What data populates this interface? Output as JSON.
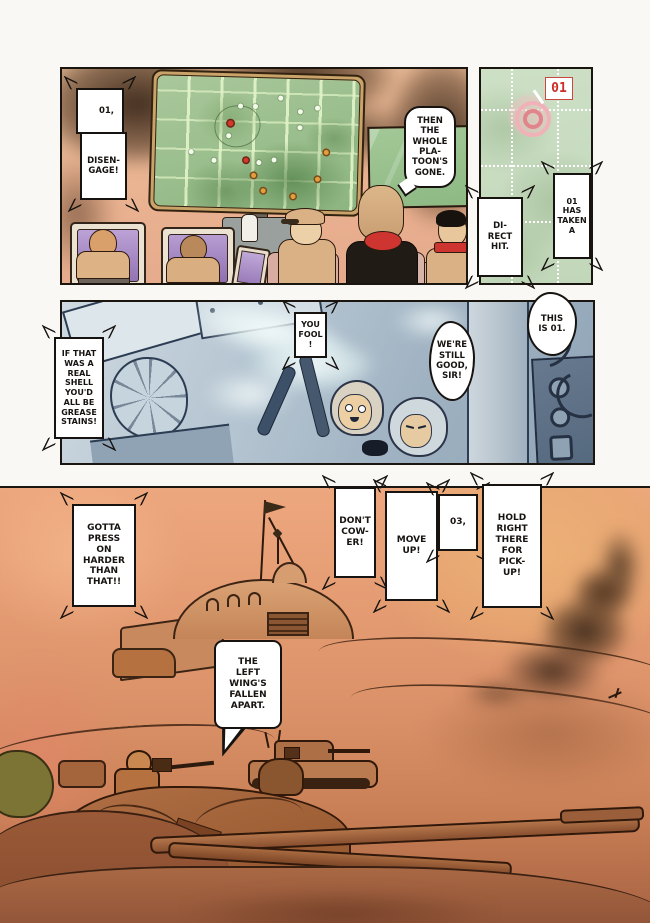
{
  "comic": {
    "radar_label": "01",
    "bubbles": {
      "order_01": "01,",
      "disengage": "DISEN-\nGAGE!",
      "platoon_gone": "THEN\nTHE\nWHOLE\nPLA-\nTOON'S\nGONE.",
      "direct_hit": "DI-\nRECT\nHIT.",
      "taken_a": "01\nHAS\nTAKEN\nA",
      "grease_stains": "IF THAT\nWAS A\nREAL\nSHELL\nYOU'D\nALL BE\nGREASE\nSTAINS!",
      "you_fool": "YOU\nFOOL\n!",
      "still_good": "WE'RE\nSTILL\nGOOD,\nSIR!",
      "this_is_01": "THIS\nIS 01.",
      "press_harder": "GOTTA\nPRESS\nON\nHARDER\nTHAN\nTHAT!!",
      "dont_cower": "DON'T\nCOW-\nER!",
      "move_up": "MOVE\nUP!",
      "unit_03": "03,",
      "hold_for_pickup": "HOLD\nRIGHT\nTHERE\nFOR\nPICK-\nUP!",
      "left_wing": "THE\nLEFT\nWING'S\nFALLEN\nAPART."
    },
    "palette": {
      "page_bg": "#faf8f4",
      "ink": "#1b1510",
      "map_green": "#9ec291",
      "map_grid": "#d4e6bc",
      "radar_green": "#c9dbc1",
      "alert_red": "#cc2d26",
      "target_pink": "#eea3aa",
      "screen_purple": "#b49bd0",
      "uniform_tan": "#d9b184",
      "interior_blue": "#a9bcca",
      "desert_orange": "#e09a73",
      "desert_amber": "#eab577",
      "smoke_brown": "#46301e"
    }
  }
}
